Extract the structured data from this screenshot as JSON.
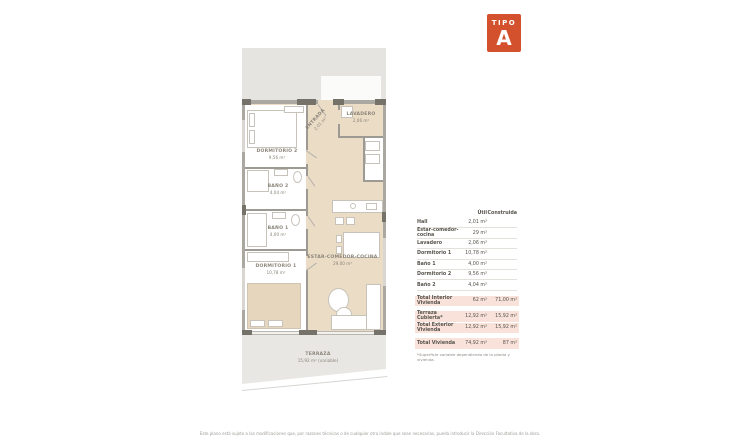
{
  "badge": {
    "type_label": "TIPO",
    "letter": "A",
    "color": "#d4512d"
  },
  "plan": {
    "dormitorio2": {
      "name": "DORMITORIO 2",
      "area": "9,56 m²"
    },
    "entrada": {
      "name": "ENTRADA",
      "area": "2,01 m²"
    },
    "lavadero": {
      "name": "LAVADERO",
      "area": "2,06 m²"
    },
    "bano2": {
      "name": "BAÑO 2",
      "area": "4,04 m²"
    },
    "bano1": {
      "name": "BAÑO 1",
      "area": "4,00 m²"
    },
    "dormitorio1": {
      "name": "DORMITORIO 1",
      "area": "10,78 m²"
    },
    "estar": {
      "name": "ESTAR-COMEDOR-COCINA",
      "area": "29,00 m²"
    },
    "terraza": {
      "name": "TERRAZA",
      "area": "15,92 m² (variable)"
    }
  },
  "table": {
    "header_util": "Útil",
    "header_construida": "Construida",
    "rows": [
      {
        "label": "Hall",
        "util": "2,01 m²",
        "construida": ""
      },
      {
        "label": "Estar-comedor-cocina",
        "util": "29 m²",
        "construida": ""
      },
      {
        "label": "Lavadero",
        "util": "2,06 m²",
        "construida": ""
      },
      {
        "label": "Dormitorio 1",
        "util": "10,78 m²",
        "construida": ""
      },
      {
        "label": "Baño 1",
        "util": "4,00 m²",
        "construida": ""
      },
      {
        "label": "Dormitorio 2",
        "util": "9,56 m²",
        "construida": ""
      },
      {
        "label": "Baño 2",
        "util": "4,04 m²",
        "construida": ""
      }
    ],
    "total_interior": {
      "label": "Total Interior Vivienda",
      "util": "62 m²",
      "construida": "71,00 m²"
    },
    "terraza_cubierta": {
      "label": "Terraza Cubierta*",
      "util": "12,92 m²",
      "construida": "15,92 m²"
    },
    "total_exterior": {
      "label": "Total Exterior Vivienda",
      "util": "12,92 m²",
      "construida": "15,92 m²"
    },
    "total_vivienda": {
      "label": "Total Vivienda",
      "util": "74,92 m²",
      "construida": "87 m²"
    },
    "footnote": "*Superficie variable dependiendo de la planta y vivienda."
  },
  "disclaimer": "Este plano está sujeto a las modificaciones que, por razones técnicas o de cualquier otra índole que sean necesarias, pueda introducir la Dirección Facultativa de la obra."
}
